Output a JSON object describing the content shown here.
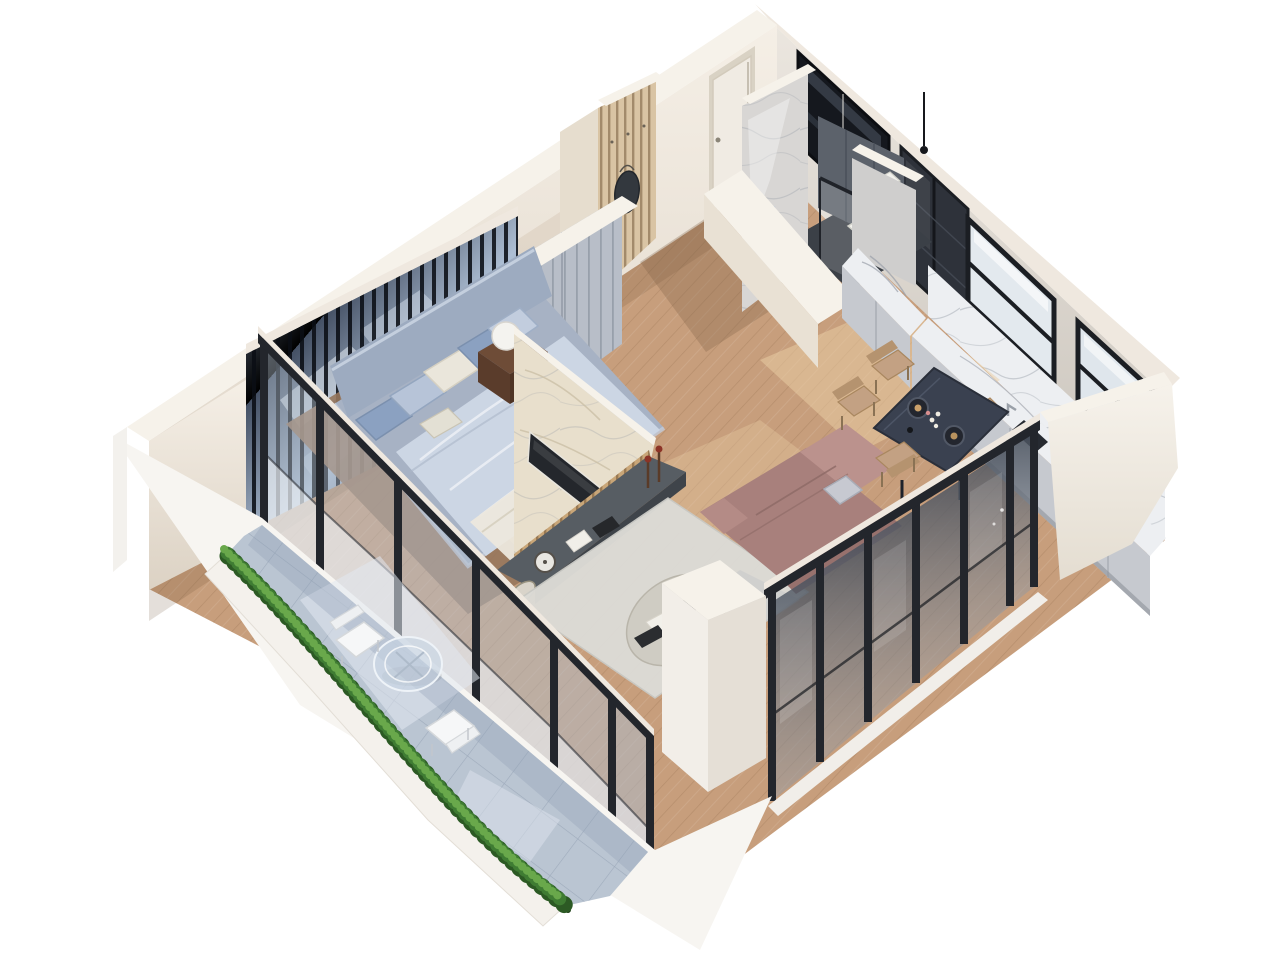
{
  "meta": {
    "type": "3d-floor-plan-cutaway-render",
    "style": "photorealistic isometric apartment visualization, white background, no text labels",
    "view_angle": "high axonometric from the south-west",
    "canvas": {
      "width": 1280,
      "height": 960
    }
  },
  "palette": {
    "background": "#ffffff",
    "wall_cream": "#efe8df",
    "wall_cream_bright": "#f6f2ea",
    "wall_cream_shadow": "#ddd3c6",
    "outer_white": "#f5f2ed",
    "frame_black": "#23262c",
    "glass_tint": "#aebccb",
    "glass_frost": "#e9edf2",
    "wood_floor": "#c79e7c",
    "wood_floor_dark": "#96765c",
    "balcony_tile": "#bac5d2",
    "hedge_green": "#3f7c33",
    "hedge_green_dark": "#2c5a24",
    "hedge_green_light": "#69a84b",
    "mirror_blue": "#5d6d85",
    "wardrobe_gray": "#b8bec8",
    "bed_frame": "#a7b2c4",
    "bed_headboard": "#9dabc0",
    "bed_duvet": "#ccd6e4",
    "pillow_blue": "#8ba1c1",
    "pillow_white": "#eae6db",
    "nightstand_wood": "#6e4c37",
    "marble_tv": "#e8dfcc",
    "tv_screen": "#24272c",
    "slat_wood": "#c9a678",
    "console_gray": "#575d63",
    "sofa_mauve": "#a8807c",
    "sofa_mauve_light": "#bb928d",
    "rug_light": "#dcdbd6",
    "coffee_table_stone": "#cfccc3",
    "dining_table_navy": "#3a4150",
    "chair_tan": "#c3a183",
    "kitchen_cabinet_gray": "#c6c9cf",
    "counter_marble": "#edeff2",
    "upper_cabinet_dark": "#2e323a",
    "bath_marble": "#d8d6d4",
    "bath_tile_dark": "#5c626b",
    "bath_floor_dark": "#3b4047",
    "chrome": "#ccd1d7",
    "fixture_white": "#f2f1ec",
    "door_white": "#f0ebe3",
    "entry_slat_wood": "#d9c4a4"
  },
  "scene": {
    "rooms": [
      {
        "name": "bedroom",
        "items": [
          "double bed",
          "blue and white pillows",
          "light-blue duvet",
          "upholstered headboard",
          "dark mirror wall with black slats",
          "gray wardrobe",
          "dark wood nightstand",
          "white table lamp",
          "glass door to balcony"
        ]
      },
      {
        "name": "entry-hall",
        "items": [
          "white entry door",
          "wood slat coat wall",
          "hanging bag",
          "wood floor"
        ]
      },
      {
        "name": "bathroom",
        "items": [
          "marble partition wall",
          "dark tiled shower wall",
          "glass shower screen",
          "chrome towel radiator",
          "white toilet",
          "white basin",
          "black pendant light",
          "dark window"
        ]
      },
      {
        "name": "kitchen",
        "items": [
          "dark glass upper cabinets",
          "marble backsplash",
          "light gray base cabinets",
          "white marble countertop",
          "undermount sink with faucet",
          "two bright windows with black frames"
        ]
      },
      {
        "name": "dining-area",
        "items": [
          "dark navy dining table",
          "four tan chairs",
          "dark plates with food",
          "white candles"
        ]
      },
      {
        "name": "living-room",
        "items": [
          "mauve corner sofa with chaise",
          "gray throw pillow",
          "large light rug",
          "oval stone coffee table",
          "black bowl",
          "decor books",
          "marble TV feature wall",
          "flat TV screen",
          "wood slat strip",
          "dark media console with decor",
          "two candle holders"
        ]
      },
      {
        "name": "balcony",
        "items": [
          "blue-gray stone tiles",
          "green privacy hedge in planter",
          "round glass table",
          "two white wire chairs",
          "black framed sliding glass facade"
        ]
      }
    ],
    "architecture": {
      "walls": "white-cream cut walls seen from above",
      "glazing": "floor-to-ceiling black framed glass on the two lower facades",
      "floors": "warm oak planks inside, stone tiles on balcony"
    }
  }
}
